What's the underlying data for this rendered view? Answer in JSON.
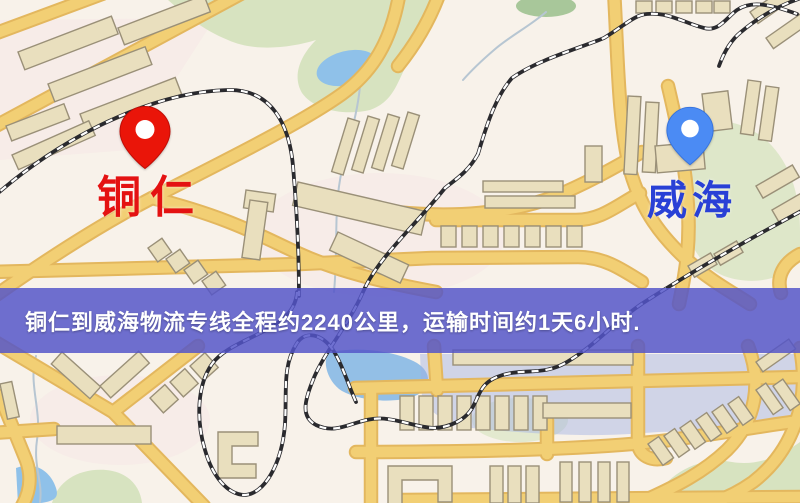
{
  "map": {
    "type": "road-map-with-route-banner",
    "banner": {
      "text": "铜仁到威海物流专线全程约2240公里，运输时间约1天6小时.",
      "distance_text": "约2240公里",
      "duration_text": "约1天6小时"
    },
    "pins": [
      {
        "id": "origin",
        "label": "铜仁",
        "icon": "red-pin-icon"
      },
      {
        "id": "destination",
        "label": "威海",
        "icon": "blue-pin-icon"
      }
    ],
    "colors": {
      "background": "#f8f2ea",
      "road": "#f2cf74",
      "road_casing": "#e3b75e",
      "building_fill": "#e9dfbe",
      "building_stroke": "#9a9078",
      "green": "#d7e3c0",
      "water": "#8fc1e9",
      "railway": "#2a2a2e",
      "banner": "#5455c8",
      "red_pin": "#ea1509",
      "red_label": "#e41212",
      "blue_pin": "#4b8bf4",
      "blue_label": "#2940d6"
    }
  }
}
